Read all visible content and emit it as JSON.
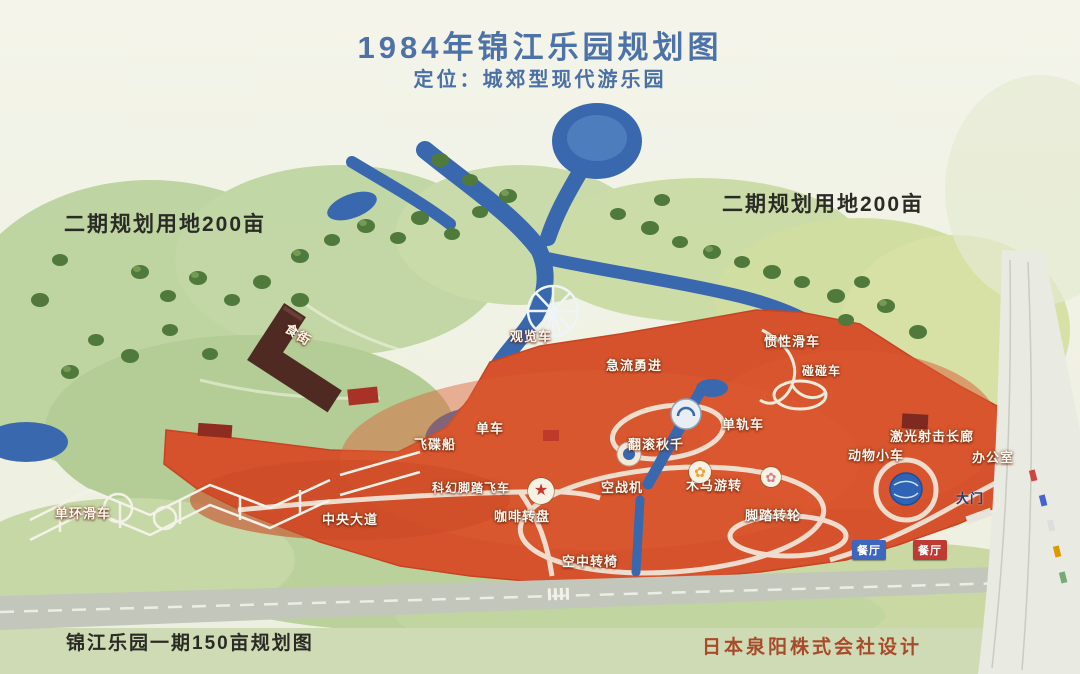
{
  "header": {
    "title": "1984年锦江乐园规划图",
    "subtitle": "定位：城郊型现代游乐园"
  },
  "annotations": {
    "phase2_left": "二期规划用地200亩",
    "phase2_right": "二期规划用地200亩",
    "phase1_caption": "锦江乐园一期150亩规划图",
    "designer_credit": "日本泉阳株式会社设计"
  },
  "labels": [
    {
      "id": "food-street",
      "text": "食街"
    },
    {
      "id": "ferris-wheel",
      "text": "观览车"
    },
    {
      "id": "log-flume",
      "text": "急流勇进"
    },
    {
      "id": "roller-coaster",
      "text": "惯性滑车"
    },
    {
      "id": "bumper-cars",
      "text": "碰碰车"
    },
    {
      "id": "bicycle",
      "text": "单车"
    },
    {
      "id": "ufo-boat",
      "text": "飞碟船"
    },
    {
      "id": "tumble-swing",
      "text": "翻滚秋千"
    },
    {
      "id": "monorail",
      "text": "单轨车"
    },
    {
      "id": "laser-gallery",
      "text": "激光射击长廊"
    },
    {
      "id": "animal-cars",
      "text": "动物小车"
    },
    {
      "id": "office",
      "text": "办公室"
    },
    {
      "id": "air-fighter",
      "text": "空战机"
    },
    {
      "id": "carousel",
      "text": "木马游转"
    },
    {
      "id": "pedal-sky-bike",
      "text": "科幻脚踏飞车"
    },
    {
      "id": "coffee-cups",
      "text": "咖啡转盘"
    },
    {
      "id": "central-avenue",
      "text": "中央大道"
    },
    {
      "id": "loop-coaster",
      "text": "单环滑车"
    },
    {
      "id": "sky-chairs",
      "text": "空中转椅"
    },
    {
      "id": "pedal-wheel",
      "text": "脚踏转轮"
    },
    {
      "id": "main-gate",
      "text": "大门"
    },
    {
      "id": "restaurant-1",
      "text": "餐厅"
    },
    {
      "id": "restaurant-2",
      "text": "餐厅"
    }
  ],
  "icons": {
    "star-plaza-icon": "★",
    "flower-icon-1": "✿",
    "flower-icon-2": "✿",
    "dial-icon": "✳"
  },
  "colors": {
    "title_text": "#4d72a8",
    "park_area_red": "#d5522c",
    "water_blue": "#3a68ae",
    "field_green": "#b5cf95",
    "annotation_text": "#2b2b26",
    "designer_text": "#a84b2c",
    "restaurant_badge_blue": "#3f66bd",
    "restaurant_badge_red": "#bf3a33",
    "food_street_building": "#4e2a22"
  }
}
